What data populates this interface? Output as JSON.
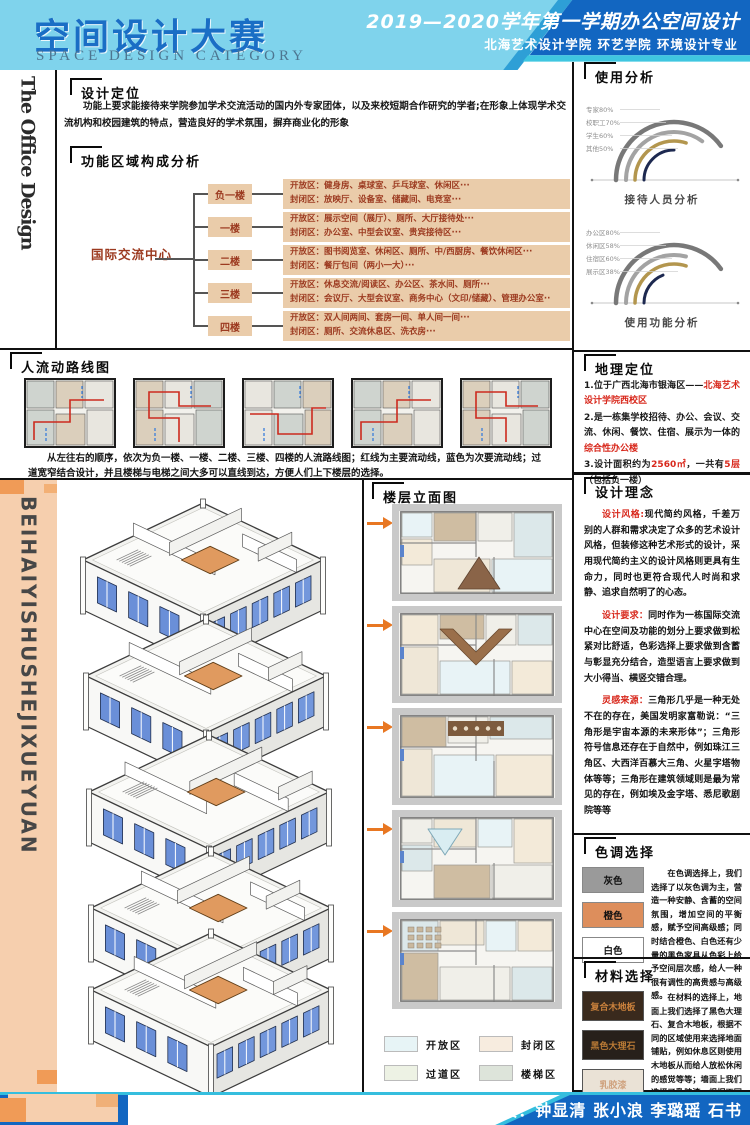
{
  "header": {
    "title_cn": "空间设计大赛",
    "title_en": "SPACE DESIGN CATEGORY",
    "semester": "2019—2020学年第一学期办公空间设计",
    "school": "北海艺术设计学院  环艺学院  环境设计专业"
  },
  "vertical_left_top": "The Office Design",
  "vertical_left_bottom": "BEIHAIYISHUSHEJIXUEYUAN",
  "design_positioning": {
    "title": "设计定位",
    "body": "功能上要求能接待来学院参加学术交流活动的国内外专家团体，以及来校短期合作研究的学者;在形象上体现学术交流机构和校园建筑的特点，营造良好的学术氛围，摒弃商业化的形象"
  },
  "functional_analysis": {
    "title": "功能区域构成分析",
    "root": "国际交流中心",
    "floors": [
      {
        "name": "负一楼",
        "open": "开放区：健身房、桌球室、乒乓球室、休闲区···",
        "closed": "封闭区：放映厅、设备室、储藏间、电竞室···"
      },
      {
        "name": "一楼",
        "open": "开放区：展示空间（展厅）、厕所、大厅接待处···",
        "closed": "封闭区：办公室、中型会议室、贵宾接待区···"
      },
      {
        "name": "二楼",
        "open": "开放区：图书阅览室、休闲区、厕所、中/西厨房、餐饮休闲区···",
        "closed": "封闭区：餐厅包间（两小一大）···"
      },
      {
        "name": "三楼",
        "open": "开放区：休息交流/阅读区、办公区、茶水间、厕所···",
        "closed": "封闭区：会议厅、大型会议室、商务中心（文印/储藏）、管理办公室··"
      },
      {
        "name": "四楼",
        "open": "开放区：双人间两间、套房一间、单人间一间···",
        "closed": "封闭区：厕所、交流休息区、洗衣房···"
      }
    ]
  },
  "usage_analysis": {
    "title": "使用分析"
  },
  "chart_data": [
    {
      "type": "arc",
      "title": "接待人员分析",
      "categories": [
        "专家",
        "校职工",
        "学生",
        "其他"
      ],
      "values": [
        80,
        70,
        60,
        50
      ],
      "unit": "%",
      "colors": [
        "#787878",
        "#a3a3a3",
        "#b3964e",
        "#1d2950"
      ]
    },
    {
      "type": "arc",
      "title": "使用功能分析",
      "categories": [
        "办公区",
        "休闲区",
        "住宿区",
        "展示区"
      ],
      "values": [
        80,
        58,
        60,
        38
      ],
      "unit": "%",
      "colors": [
        "#787878",
        "#a3a3a3",
        "#b3964e",
        "#1d2950"
      ]
    }
  ],
  "circulation": {
    "title": "人流动路线图",
    "caption": "从左往右的顺序，依次为负一楼、一楼、二楼、三楼、四楼的人流路线图；红线为主要流动线，蓝色为次要流动线；过道宽窄结合设计，并且楼梯与电梯之间大多可以直线到达，方便人们上下楼层的选择。"
  },
  "geo": {
    "title": "地理定位",
    "l1a": "1.位于广西北海市银海区——",
    "l1b": "北海艺术设计学院西校区",
    "l2a": "2.是一栋集学校招待、办公、会议、交流、休闲、餐饮、住宿、展示为一体的",
    "l2b": "综合性办公楼",
    "l3a": "3.设计面积约为",
    "l3b": "2560㎡",
    "l3c": "，一共有",
    "l3d": "5层",
    "l3e": "（包括负一楼）"
  },
  "concept": {
    "title": "设计理念",
    "p1_lead": "设计风格:",
    "p1_body": "现代简约风格，千差万别的人群和需求决定了众多的艺术设计风格，但装修这种艺术形式的设计，采用现代简约主义的设计风格则更具有生命力，同时也更符合现代人时尚和求静、追求自然明了的心态。",
    "p2_lead": "设计要求：",
    "p2_body": "同时作为一栋国际交流中心在空间及功能的划分上要求做到松紧对比舒适，色彩选择上要求做到含蓄与彰显充分结合，造型语言上要求做到大小得当、横竖交错合理。",
    "p3_lead": "灵感来源：",
    "p3_body": "三角形几乎是一种无处不在的存在，美国发明家富勒说：“三角形是宇宙本源的未来形体”；三角形符号信息还存在于自然中，例如珠江三角区、大西洋百慕大三角、火星字塔物体等等；三角形在建筑领域则是最为常见的存在，例如埃及金字塔、悉尼歌剧院等等"
  },
  "color_scheme": {
    "title": "色调选择",
    "swatches": [
      {
        "label": "灰色",
        "color": "#9a9a9a"
      },
      {
        "label": "橙色",
        "color": "#dd8e5c"
      },
      {
        "label": "白色",
        "color": "#ffffff"
      }
    ],
    "body": "在色调选择上，我们选择了以灰色调为主，营造一种安静、含蓄的空间氛围，增加空间的平衡感，赋予空间高级感；同时结合橙色、白色还有少量的黑色家具从色彩上给予空间层次感，给人一种很有调性的高贵感与高级感。"
  },
  "materials": {
    "title": "材料选择",
    "swatches": [
      {
        "label": "复合木地板",
        "color": "#3a2a1d",
        "text_color": "#c9803c"
      },
      {
        "label": "黑色大理石",
        "color": "#27201a",
        "text_color": "#b97a35"
      },
      {
        "label": "乳胶漆",
        "color": "#eae2d6",
        "text_color": "#cfa27e"
      }
    ],
    "body": "在材料的选择上，地面上我们选择了黑色大理石、复合木地板，根据不同的区域使用来选择地面铺贴，例如休息区则使用木地板从而给人放松休闲的感觉等等；墙面上我们选择了乳胶漆，根据不同区域使用不同颜色的乳胶漆，用于区分空间以及简单的装饰作用。"
  },
  "elevation": {
    "title": "楼层立面图"
  },
  "legend": {
    "items": [
      {
        "label": "开放区",
        "color": "#e7f4f6"
      },
      {
        "label": "封闭区",
        "color": "#f7ecdf"
      },
      {
        "label": "过道区",
        "color": "#edf2e4"
      },
      {
        "label": "楼梯区",
        "color": "#dde4da"
      }
    ]
  },
  "footer": {
    "class_label": "班级：",
    "class_value": "环本1713班",
    "members_label": "组员：",
    "members_value": "钟显清  张小浪  李璐瑶  石书"
  }
}
